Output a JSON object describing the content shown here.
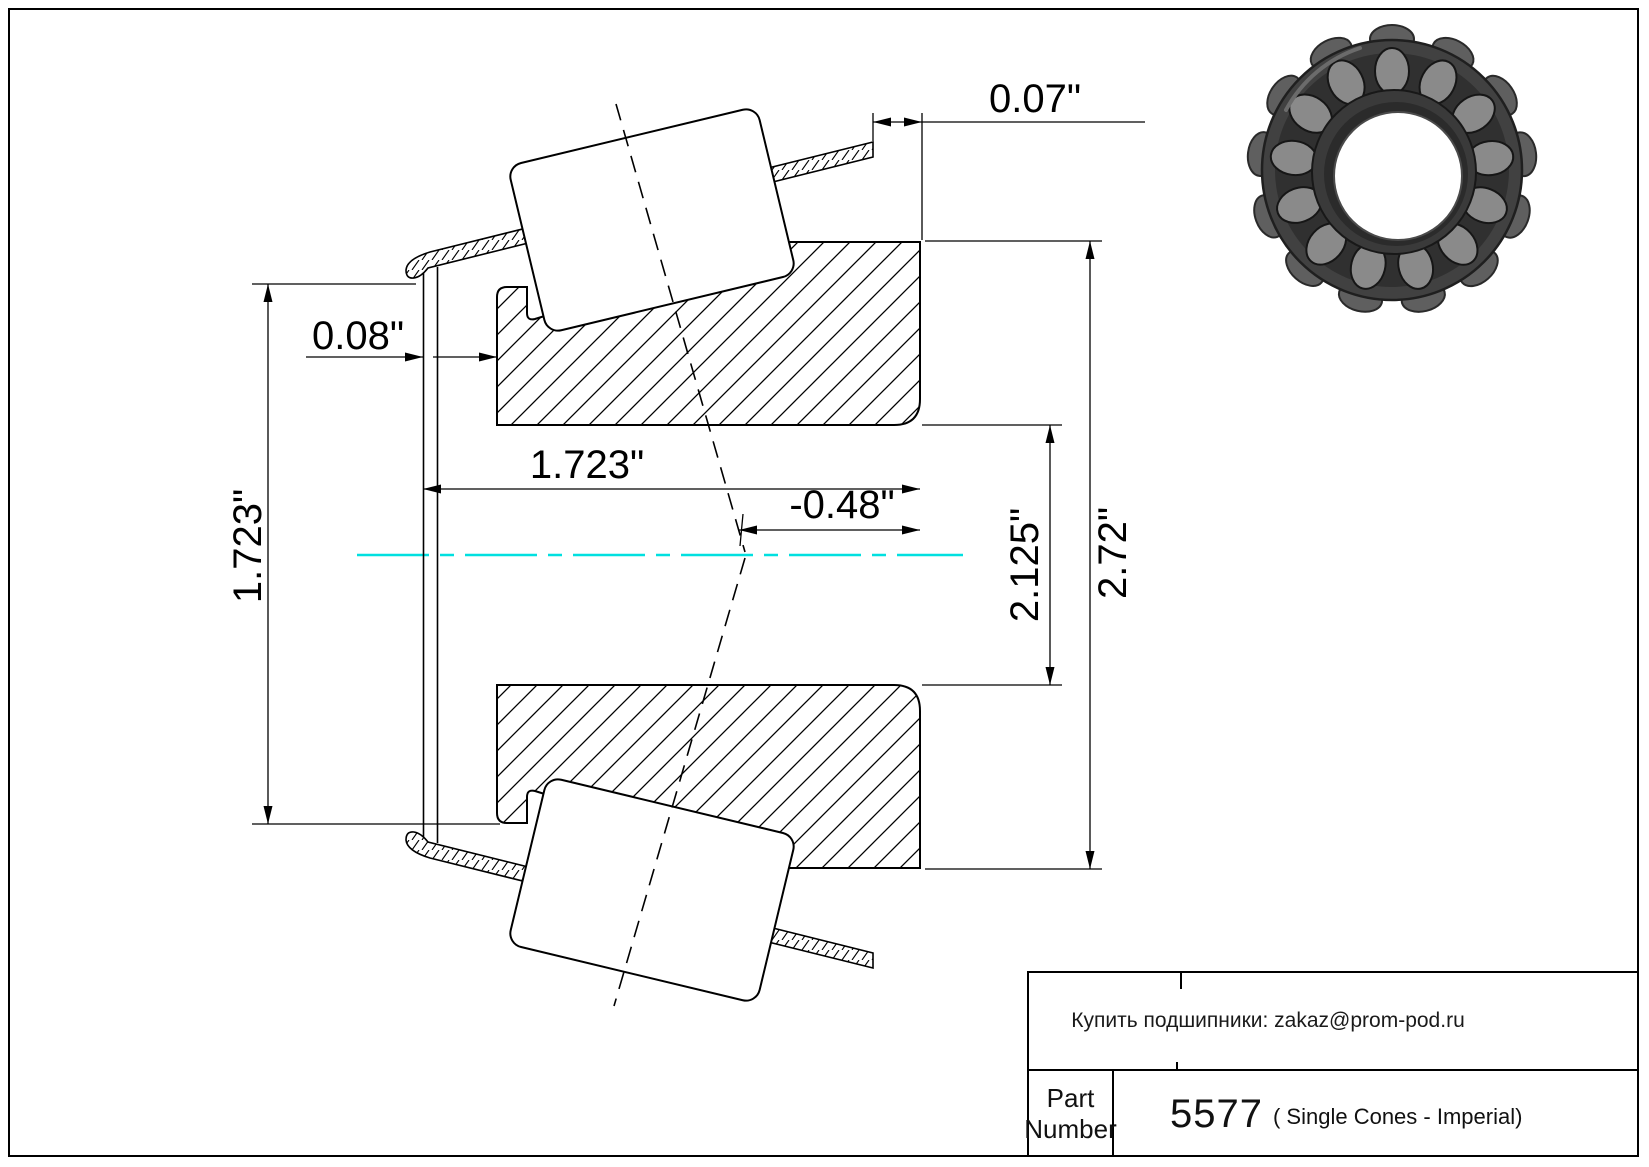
{
  "title_block": {
    "contact": "Купить подшипники: zakaz@prom-pod.ru",
    "part_label_line1": "Part",
    "part_label_line2": "Number",
    "part_number": "5577",
    "part_type": "( Single Cones - Imperial)"
  },
  "dimensions": {
    "cage_standout_back": "0.07\"",
    "cage_standout_front": "0.08\"",
    "cone_width": "1.723\"",
    "front_flange_diameter": "1.723\"",
    "effective_center": "-0.48\"",
    "bore_diameter": "2.125\"",
    "outside_diameter": "2.72\""
  },
  "colors": {
    "centerline": "#00e0e0",
    "line": "#000000",
    "background": "#ffffff",
    "bearing_dark": "#3d3d3d",
    "bearing_roller": "#8a8a8a"
  },
  "icons": {
    "bearing_photo": "tapered-roller-bearing-cone-photo"
  }
}
